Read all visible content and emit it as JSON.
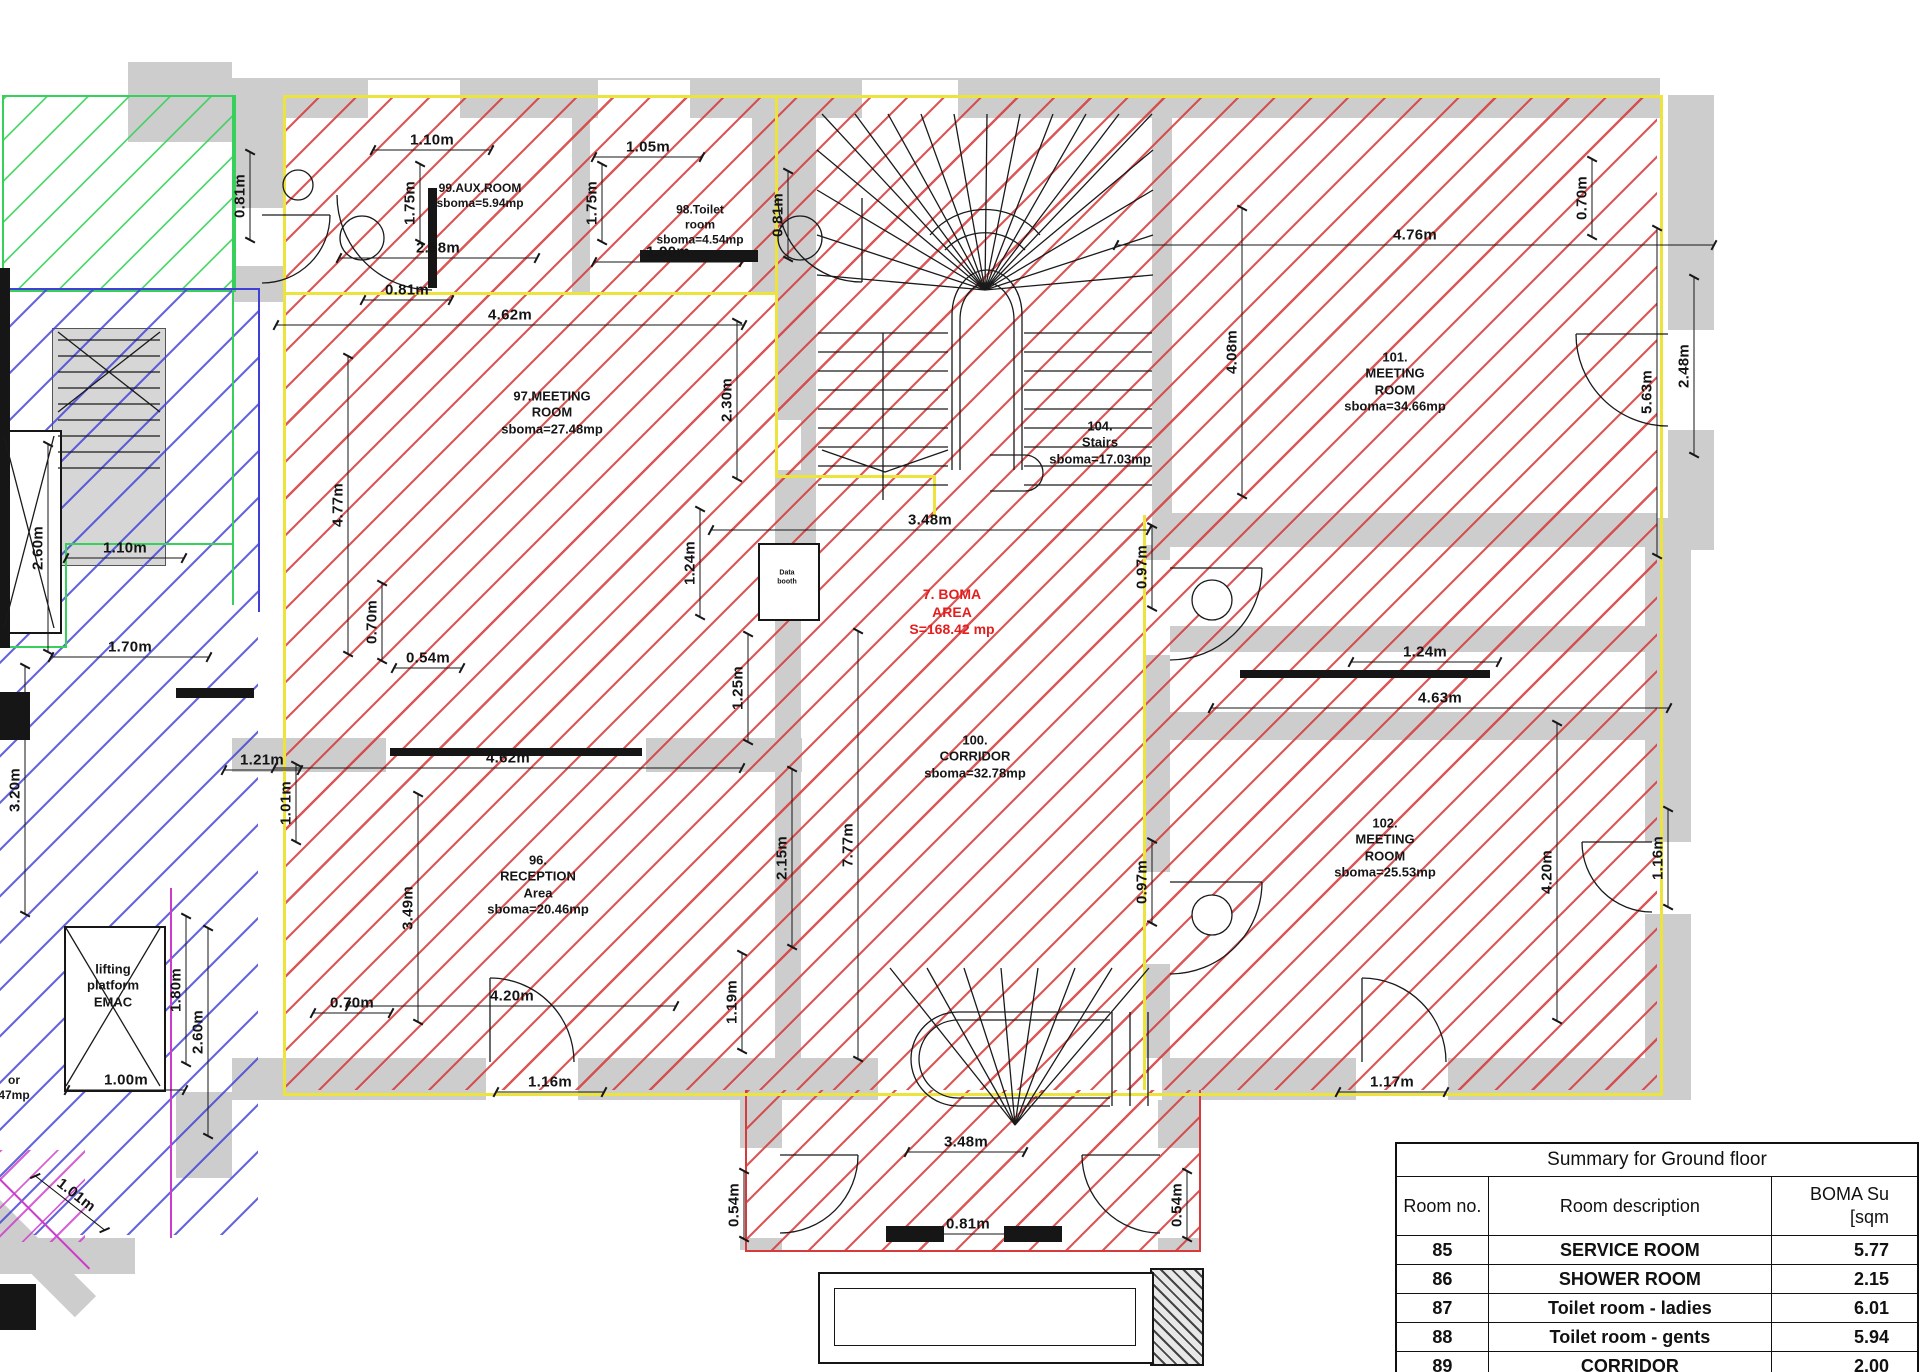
{
  "plan": {
    "room_labels": [
      {
        "id": "room-99-aux",
        "lines": [
          "99.AUX.ROOM",
          "sboma=5.94mp"
        ],
        "x": 480,
        "y": 196,
        "fs": 12,
        "color": "#161616"
      },
      {
        "id": "room-98-toilet",
        "lines": [
          "98.Toilet",
          "room",
          "sboma=4.54mp"
        ],
        "x": 700,
        "y": 225,
        "fs": 12,
        "color": "#161616"
      },
      {
        "id": "room-97-meeting",
        "lines": [
          "97.MEETING",
          "ROOM",
          "sboma=27.48mp"
        ],
        "x": 552,
        "y": 413,
        "fs": 13,
        "color": "#161616"
      },
      {
        "id": "room-104-stairs",
        "lines": [
          "104.",
          "Stairs",
          "sboma=17.03mp"
        ],
        "x": 1100,
        "y": 443,
        "fs": 13,
        "color": "#161616"
      },
      {
        "id": "boma-area",
        "lines": [
          "7. BOMA",
          "AREA",
          "S=168.42 mp"
        ],
        "x": 952,
        "y": 612,
        "fs": 14,
        "color": "#e31e1e"
      },
      {
        "id": "room-100-corridor",
        "lines": [
          "100.",
          "CORRIDOR",
          "sboma=32.78mp"
        ],
        "x": 975,
        "y": 757,
        "fs": 13,
        "color": "#161616"
      },
      {
        "id": "room-101-meeting",
        "lines": [
          "101.",
          "MEETING",
          "ROOM",
          "sboma=34.66mp"
        ],
        "x": 1395,
        "y": 382,
        "fs": 13,
        "color": "#161616"
      },
      {
        "id": "room-102-meeting",
        "lines": [
          "102.",
          "MEETING",
          "ROOM",
          "sboma=25.53mp"
        ],
        "x": 1385,
        "y": 848,
        "fs": 13,
        "color": "#161616"
      },
      {
        "id": "room-96-reception",
        "lines": [
          "96.",
          "RECEPTION",
          "Area",
          "sboma=20.46mp"
        ],
        "x": 538,
        "y": 885,
        "fs": 13,
        "color": "#161616"
      },
      {
        "id": "lifting-platform",
        "lines": [
          "lifting",
          "platform",
          "EMAC"
        ],
        "x": 113,
        "y": 986,
        "fs": 13,
        "color": "#161616"
      },
      {
        "id": "data-box",
        "lines": [
          "Data",
          "booth"
        ],
        "x": 787,
        "y": 578,
        "fs": 7,
        "color": "#161616"
      },
      {
        "id": "edge-partial",
        "lines": [
          "or",
          "47mp"
        ],
        "x": 14,
        "y": 1088,
        "fs": 12,
        "color": "#161616"
      }
    ],
    "dimensions": [
      {
        "t": "1.10m",
        "x": 432,
        "y": 150,
        "r": 0,
        "l": 120
      },
      {
        "t": "1.05m",
        "x": 648,
        "y": 157,
        "r": 0,
        "l": 110
      },
      {
        "t": "2.58m",
        "x": 438,
        "y": 258,
        "r": 0,
        "l": 200
      },
      {
        "t": "1.90m",
        "x": 668,
        "y": 262,
        "r": 0,
        "l": 150
      },
      {
        "t": "0.81m",
        "x": 407,
        "y": 300,
        "r": 0,
        "l": 90
      },
      {
        "t": "4.62m",
        "x": 510,
        "y": 325,
        "r": 0,
        "l": 470
      },
      {
        "t": "0.54m",
        "x": 428,
        "y": 668,
        "r": 0,
        "l": 70
      },
      {
        "t": "4.62m",
        "x": 508,
        "y": 768,
        "r": 0,
        "l": 470
      },
      {
        "t": "1.21m",
        "x": 262,
        "y": 770,
        "r": 0,
        "l": 78
      },
      {
        "t": "0.70m",
        "x": 352,
        "y": 1013,
        "r": 0,
        "l": 80
      },
      {
        "t": "4.20m",
        "x": 512,
        "y": 1006,
        "r": 0,
        "l": 330
      },
      {
        "t": "1.16m",
        "x": 550,
        "y": 1092,
        "r": 0,
        "l": 110
      },
      {
        "t": "1.10m",
        "x": 125,
        "y": 558,
        "r": 0,
        "l": 120
      },
      {
        "t": "1.70m",
        "x": 130,
        "y": 657,
        "r": 0,
        "l": 160
      },
      {
        "t": "1.00m",
        "x": 126,
        "y": 1090,
        "r": 0,
        "l": 120
      },
      {
        "t": "3.48m",
        "x": 930,
        "y": 530,
        "r": 0,
        "l": 440
      },
      {
        "t": "3.48m",
        "x": 966,
        "y": 1152,
        "r": 0,
        "l": 120
      },
      {
        "t": "0.81m",
        "x": 968,
        "y": 1234,
        "r": 0,
        "l": 95
      },
      {
        "t": "1.17m",
        "x": 1392,
        "y": 1092,
        "r": 0,
        "l": 110
      },
      {
        "t": "4.76m",
        "x": 1415,
        "y": 245,
        "r": 0,
        "l": 600
      },
      {
        "t": "1.24m",
        "x": 1425,
        "y": 662,
        "r": 0,
        "l": 150
      },
      {
        "t": "4.63m",
        "x": 1440,
        "y": 708,
        "r": 0,
        "l": 460
      },
      {
        "t": "0.81m",
        "x": 250,
        "y": 196,
        "r": 90,
        "l": 90
      },
      {
        "t": "1.75m",
        "x": 420,
        "y": 203,
        "r": 90,
        "l": 80
      },
      {
        "t": "1.75m",
        "x": 602,
        "y": 203,
        "r": 90,
        "l": 80
      },
      {
        "t": "0.81m",
        "x": 788,
        "y": 215,
        "r": 90,
        "l": 90
      },
      {
        "t": "2.30m",
        "x": 737,
        "y": 400,
        "r": 90,
        "l": 160
      },
      {
        "t": "4.77m",
        "x": 348,
        "y": 505,
        "r": 90,
        "l": 300
      },
      {
        "t": "0.70m",
        "x": 382,
        "y": 622,
        "r": 90,
        "l": 80
      },
      {
        "t": "1.24m",
        "x": 700,
        "y": 563,
        "r": 90,
        "l": 110
      },
      {
        "t": "1.25m",
        "x": 748,
        "y": 688,
        "r": 90,
        "l": 110
      },
      {
        "t": "1.01m",
        "x": 296,
        "y": 803,
        "r": 90,
        "l": 80
      },
      {
        "t": "3.49m",
        "x": 418,
        "y": 908,
        "r": 90,
        "l": 230
      },
      {
        "t": "2.15m",
        "x": 792,
        "y": 858,
        "r": 90,
        "l": 180
      },
      {
        "t": "7.77m",
        "x": 858,
        "y": 845,
        "r": 90,
        "l": 430
      },
      {
        "t": "1.19m",
        "x": 742,
        "y": 1002,
        "r": 90,
        "l": 100
      },
      {
        "t": "0.54m",
        "x": 744,
        "y": 1205,
        "r": 90,
        "l": 70
      },
      {
        "t": "0.54m",
        "x": 1187,
        "y": 1205,
        "r": 90,
        "l": 70
      },
      {
        "t": "0.97m",
        "x": 1152,
        "y": 567,
        "r": 90,
        "l": 85
      },
      {
        "t": "0.97m",
        "x": 1152,
        "y": 882,
        "r": 90,
        "l": 85
      },
      {
        "t": "4.08m",
        "x": 1242,
        "y": 352,
        "r": 90,
        "l": 290
      },
      {
        "t": "0.70m",
        "x": 1592,
        "y": 198,
        "r": 90,
        "l": 80
      },
      {
        "t": "5.63m",
        "x": 1657,
        "y": 392,
        "r": 90,
        "l": 330
      },
      {
        "t": "2.48m",
        "x": 1694,
        "y": 366,
        "r": 90,
        "l": 180
      },
      {
        "t": "1.16m",
        "x": 1668,
        "y": 858,
        "r": 90,
        "l": 100
      },
      {
        "t": "4.20m",
        "x": 1557,
        "y": 872,
        "r": 90,
        "l": 300
      },
      {
        "t": "2.60m",
        "x": 48,
        "y": 548,
        "r": 90,
        "l": 210
      },
      {
        "t": "3.20m",
        "x": 25,
        "y": 790,
        "r": 90,
        "l": 250
      },
      {
        "t": "2.60m",
        "x": 208,
        "y": 1032,
        "r": 90,
        "l": 210
      },
      {
        "t": "1.80m",
        "x": 186,
        "y": 990,
        "r": 90,
        "l": 150
      },
      {
        "t": "1.01m",
        "x": 70,
        "y": 1203,
        "r": 38,
        "l": 90
      }
    ]
  },
  "summary_table": {
    "title": "Summary for Ground floor",
    "col1": "Room no.",
    "col2": "Room description",
    "col3_line1": "BOMA Su",
    "col3_line2": "[sqm",
    "rows": [
      {
        "no": "85",
        "desc": "SERVICE ROOM",
        "area": "5.77"
      },
      {
        "no": "86",
        "desc": "SHOWER ROOM",
        "area": "2.15"
      },
      {
        "no": "87",
        "desc": "Toilet room - ladies",
        "area": "6.01"
      },
      {
        "no": "88",
        "desc": "Toilet room - gents",
        "area": "5.94"
      },
      {
        "no": "89",
        "desc": "CORRIDOR",
        "area": "2.00"
      }
    ]
  },
  "colors": {
    "hatch_red": "#d63a3a",
    "hatch_blue": "#4040d6",
    "hatch_green": "#37d05a",
    "hatch_magenta": "#cc3ccc",
    "boundary_yellow": "#ece33c",
    "wall_gray": "#cdcdcd",
    "boma_text_red": "#e31e1e"
  }
}
